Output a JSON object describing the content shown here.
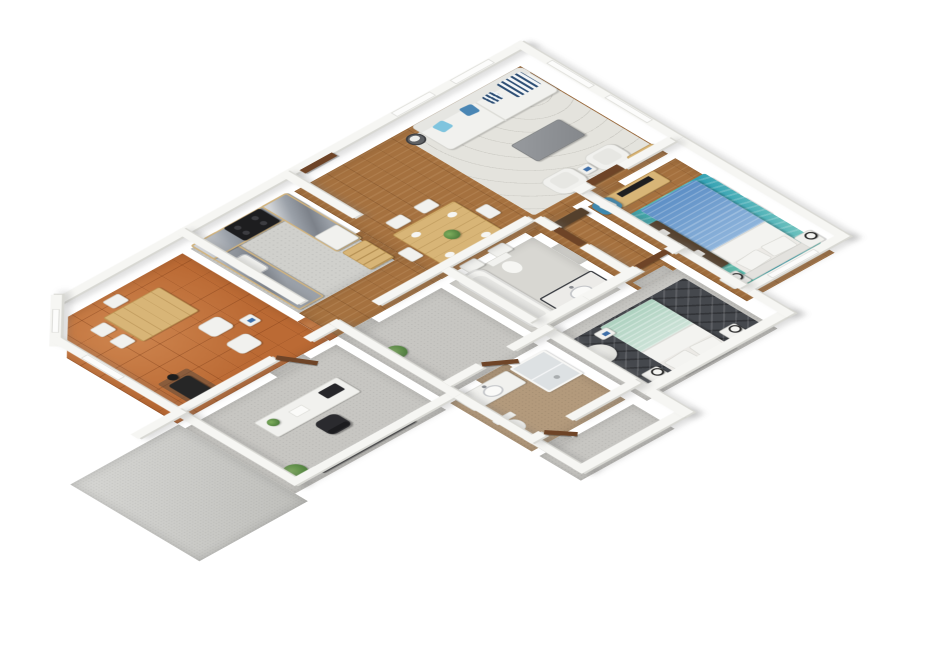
{
  "scene": {
    "type": "isometric-3d-floor-plan-render",
    "background": "#ffffff",
    "view": "rotated top-down dollhouse view, white walls, no ground shadow",
    "palette": {
      "wall": "#f6f6f3",
      "wall_shade": "#d8d8d3",
      "wood_floor": "#a5713f",
      "terracotta_tile": "#bb6a34",
      "gray_carpet": "#c7c6c2",
      "kitchen_floor": "#d0d0cc",
      "bathroom_tan_floor": "#b39a7c",
      "patio_concrete": "#c9c9c5",
      "door_wood": "#6e4427",
      "counter_marble": "#9ba1a9",
      "cabinet_pine": "#d8b577",
      "sofa_white": "#f1f1ee",
      "pillow_blue": "#7fc4de",
      "duvet_blue": "#5d8fc6",
      "rug_teal": "#2f9fb3",
      "duvet_mint": "#aed2c0",
      "rug_dark_marble": "#45484d",
      "armchair_blue": "#3e88ae"
    },
    "rooms": [
      {
        "id": "family-room",
        "name": "Family room",
        "floor": "terracotta tile",
        "furniture": [
          "pine table with white chairs",
          "two white lounge chairs",
          "white side table",
          "black wood stove with flue"
        ],
        "features": [
          "chamfered corner wall with window",
          "window on left wall"
        ]
      },
      {
        "id": "kitchen",
        "name": "Kitchen",
        "floor": "light gray",
        "furniture": [
          "U-shaped pine cabinets with gray marble countertop",
          "black range cooker",
          "white sink",
          "white refrigerator",
          "pine ladder shelf"
        ]
      },
      {
        "id": "living-dining",
        "name": "Open living / dining room",
        "floor": "wood planks",
        "furniture": [
          "white sofa with blue pillows",
          "round dark basket",
          "gray coffee table",
          "two white armchairs",
          "white side table",
          "pine TV bench with TV",
          "pine dining table with plant and place settings",
          "six white dining chairs"
        ],
        "features": [
          "entry door on top wall",
          "two windows on top wall",
          "two windows on right wall"
        ]
      },
      {
        "id": "master-bedroom",
        "name": "Master bedroom",
        "floor": "wood planks + teal patterned rug",
        "furniture": [
          "double bed with blue duvet and white pillows",
          "two white nightstands with lamps",
          "pine dresser with TV",
          "blue armchair with white pillow",
          "dark wardrobe",
          "white closet panels"
        ],
        "features": [
          "window on bottom wall"
        ]
      },
      {
        "id": "bathroom-1",
        "name": "Main bathroom",
        "floor": "light gray",
        "furniture": [
          "bathtub",
          "toilet",
          "vanity with round sink"
        ]
      },
      {
        "id": "hallway",
        "name": "Hallway",
        "floor": "wood planks",
        "furniture": [
          "dark built-in closet"
        ]
      },
      {
        "id": "bedroom-2",
        "name": "Second bedroom",
        "floor": "gray carpet + dark marble rug",
        "furniture": [
          "double bed with mint duvet and white pillows",
          "two white nightstands with lamps",
          "round fluffy armchair",
          "small white side table"
        ]
      },
      {
        "id": "office",
        "name": "Office",
        "floor": "gray carpet",
        "furniture": [
          "white desk",
          "dark monitor",
          "black office chair",
          "potted plants",
          "dark credenza"
        ]
      },
      {
        "id": "storage-room",
        "name": "Storage room",
        "floor": "gray carpet",
        "furniture": [
          "potted plant"
        ]
      },
      {
        "id": "bathroom-2",
        "name": "Second bathroom",
        "floor": "tan",
        "furniture": [
          "white vanity with sink",
          "toilet",
          "glass shower"
        ]
      },
      {
        "id": "utility-room",
        "name": "Utility room",
        "floor": "gray carpet",
        "furniture": []
      },
      {
        "id": "patio",
        "name": "Patio",
        "floor": "concrete slab",
        "furniture": []
      }
    ]
  }
}
